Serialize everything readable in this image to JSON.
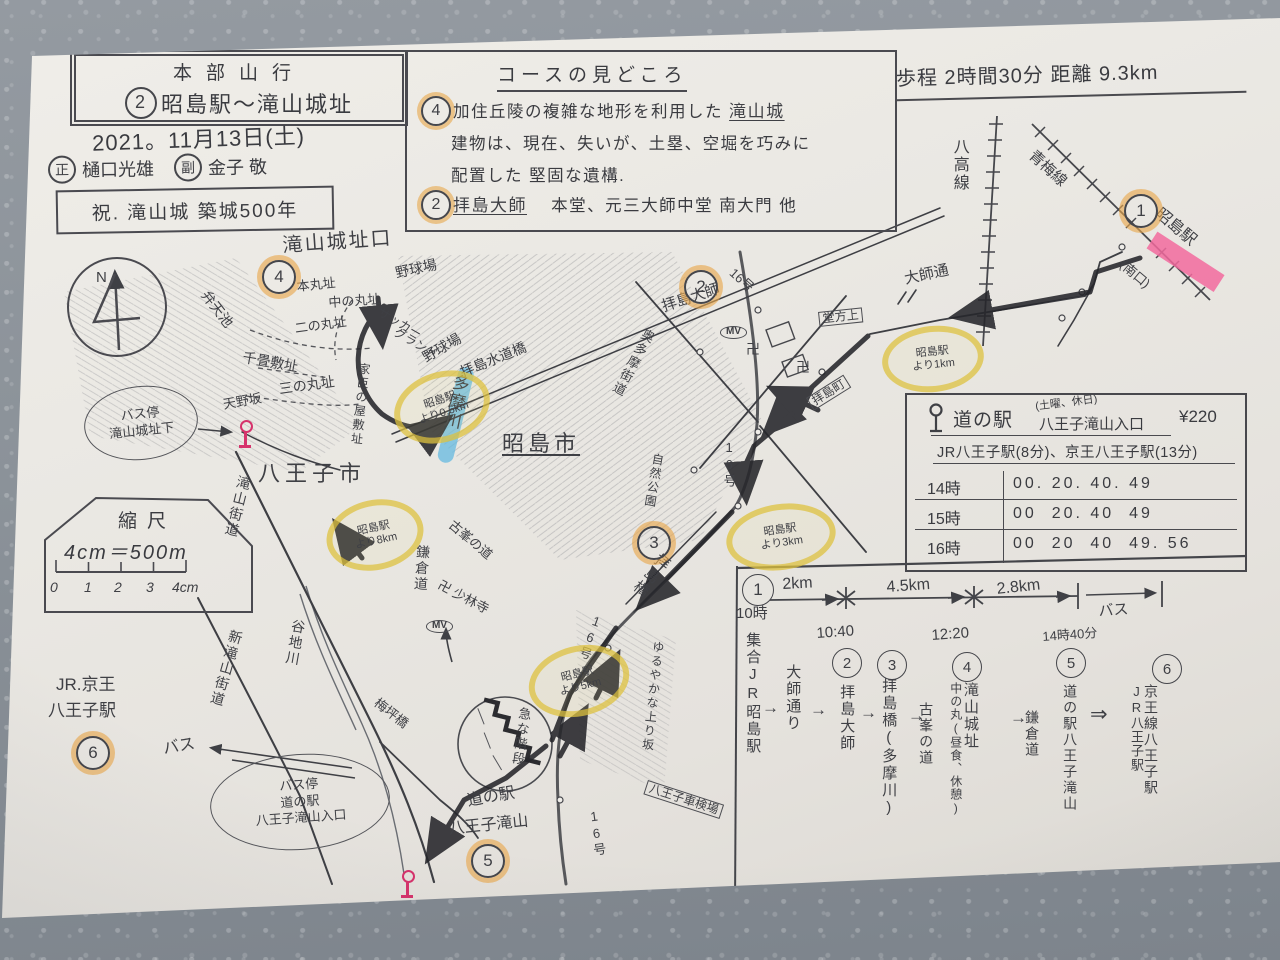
{
  "header": {
    "club": "本部山行",
    "course_no": "2",
    "course_title": "昭島駅〜滝山城址",
    "date": "2021。11月13日(土)",
    "leader_role": "正",
    "leader_name": "樋口光雄",
    "subleader_role": "副",
    "subleader_name": "金子 敬",
    "anniversary": "祝. 滝山城 築城500年",
    "stats": "歩程 2時間30分 距離 9.3km"
  },
  "course_box": {
    "title": "コースの見どころ",
    "item1_num": "4",
    "item1_line1": "加住丘陵の複雑な地形を利用した",
    "item1_line1_em": "滝山城",
    "item1_line2": "建物は、現在、失いが、土塁、空堀を巧みに",
    "item1_line3": "配置した 堅固な遺構.",
    "item2_num": "2",
    "item2_em": "拝島大師",
    "item2_text": "本堂、元三大師中堂 南大門 他"
  },
  "timetable": {
    "stop_name": "道の駅",
    "stop_name2": "八王子滝山入口",
    "note": "(土曜、休日)",
    "fare": "¥220",
    "access": "JR八王子駅(8分)、京王八王子駅(13分)",
    "rows": [
      {
        "hour": "14時",
        "times": "00. 20. 40. 49"
      },
      {
        "hour": "15時",
        "times": "00  20. 40  49"
      },
      {
        "hour": "16時",
        "times": "00  20  40  49. 56"
      }
    ]
  },
  "itinerary": {
    "seg1": "2km",
    "seg2": "4.5km",
    "seg3": "2.8km",
    "seg4": "バス",
    "t1": "10時",
    "t2": "10:40",
    "t4": "12:20",
    "t5": "14時40分",
    "n1": "1",
    "n2": "2",
    "n3": "3",
    "n4": "4",
    "n5": "5",
    "n6": "6",
    "s1": "集合JR昭島駅",
    "via1": "大師通り",
    "s2": "拝島大師",
    "s3": "拝島橋(多摩川)",
    "via2": "古峯の道",
    "s4": "滝山城址",
    "s4_note": "中の丸(昼食、休憩)",
    "via3": "鎌倉道",
    "s5": "道の駅八王子滝山",
    "s6": "京王線八王子駅",
    "s6_note": "JR八王子駅",
    "arrow": "→",
    "darrow": "⇒"
  },
  "scale": {
    "title": "縮尺",
    "formula": "4cm＝500m"
  },
  "map": {
    "labels": [
      {
        "t": "八高線",
        "x": 950,
        "y": 138,
        "s": 16,
        "v": 1
      },
      {
        "t": "青梅線",
        "x": 1036,
        "y": 148,
        "s": 15,
        "rot": 42
      },
      {
        "t": "昭島駅",
        "x": 1162,
        "y": 206,
        "s": 16,
        "rot": 40
      },
      {
        "t": "(南口)",
        "x": 1126,
        "y": 258,
        "s": 13,
        "rot": 40
      },
      {
        "t": "大師通",
        "x": 903,
        "y": 272,
        "s": 15,
        "rot": -12
      },
      {
        "t": "滝山城址口",
        "x": 282,
        "y": 236,
        "s": 20,
        "rot": -4,
        "sp": 2
      },
      {
        "t": "本丸址",
        "x": 296,
        "y": 280,
        "s": 13,
        "rot": -6
      },
      {
        "t": "中の丸址",
        "x": 328,
        "y": 296,
        "s": 13,
        "rot": -4
      },
      {
        "t": "二の丸址",
        "x": 294,
        "y": 322,
        "s": 13,
        "rot": -8
      },
      {
        "t": "弁天池",
        "x": 210,
        "y": 288,
        "s": 14,
        "rot": 52
      },
      {
        "t": "千畳敷址",
        "x": 244,
        "y": 350,
        "s": 14,
        "rot": 10
      },
      {
        "t": "三の丸址",
        "x": 278,
        "y": 382,
        "s": 14,
        "rot": -8
      },
      {
        "t": "天野坂",
        "x": 222,
        "y": 398,
        "s": 13,
        "rot": -10
      },
      {
        "t": "家臣の屋敷址",
        "x": 358,
        "y": 362,
        "s": 12,
        "v": 1,
        "rot": 6
      },
      {
        "t": "野球場",
        "x": 394,
        "y": 266,
        "s": 14,
        "rot": -12
      },
      {
        "t": "サッカー",
        "x": 382,
        "y": 306,
        "s": 12,
        "rot": 30
      },
      {
        "t": "グランド",
        "x": 398,
        "y": 326,
        "s": 12,
        "rot": 30
      },
      {
        "t": "野球場",
        "x": 420,
        "y": 352,
        "s": 14,
        "rot": -30
      },
      {
        "t": "拝島水道橋",
        "x": 458,
        "y": 366,
        "s": 14,
        "rot": -22
      },
      {
        "t": "多摩川",
        "x": 452,
        "y": 372,
        "s": 17,
        "v": 1,
        "rot": 12
      },
      {
        "t": "昭島市",
        "x": 502,
        "y": 432,
        "s": 22,
        "sp": 4,
        "cls": "u"
      },
      {
        "t": "八王子市",
        "x": 258,
        "y": 462,
        "s": 22,
        "sp": 5
      },
      {
        "t": "自然公園",
        "x": 652,
        "y": 452,
        "s": 12,
        "v": 1,
        "rot": 10
      },
      {
        "t": "滝山街道",
        "x": 238,
        "y": 474,
        "s": 14,
        "v": 1,
        "rot": 14
      },
      {
        "t": "新滝山街道",
        "x": 230,
        "y": 628,
        "s": 14,
        "v": 1,
        "rot": 16
      },
      {
        "t": "谷地川",
        "x": 292,
        "y": 618,
        "s": 14,
        "v": 1,
        "rot": 10
      },
      {
        "t": "鎌倉道",
        "x": 416,
        "y": 544,
        "s": 14,
        "v": 1,
        "rot": 4
      },
      {
        "t": "卍 少林寺",
        "x": 442,
        "y": 578,
        "s": 13,
        "rot": 28
      },
      {
        "t": "古峯の道",
        "x": 455,
        "y": 518,
        "s": 13,
        "rot": 40
      },
      {
        "t": "梅坪橋",
        "x": 380,
        "y": 696,
        "s": 13,
        "rot": 38
      },
      {
        "t": "急な階段",
        "x": 518,
        "y": 706,
        "s": 13,
        "v": 1,
        "rot": 8
      },
      {
        "t": "道の駅",
        "x": 466,
        "y": 794,
        "s": 16,
        "rot": -10
      },
      {
        "t": "八王子滝山",
        "x": 448,
        "y": 822,
        "s": 16,
        "rot": -6
      },
      {
        "t": "ゆるやかな上り坂",
        "x": 652,
        "y": 640,
        "s": 12,
        "v": 1,
        "rot": 6
      },
      {
        "t": "八王子車検場",
        "x": 648,
        "y": 780,
        "s": 12,
        "rot": 18,
        "cls": "boxed"
      },
      {
        "t": "16号",
        "x": 736,
        "y": 266,
        "s": 13,
        "rot": 42
      },
      {
        "t": "16号",
        "x": 722,
        "y": 440,
        "s": 13,
        "v": 1
      },
      {
        "t": "16号",
        "x": 592,
        "y": 612,
        "s": 13,
        "v": 1,
        "rot": 20
      },
      {
        "t": "16号",
        "x": 586,
        "y": 810,
        "s": 13,
        "v": 1,
        "rot": -8
      },
      {
        "t": "拝島橋",
        "x": 660,
        "y": 550,
        "s": 15,
        "v": 1,
        "rot": 38
      },
      {
        "t": "拝島大師",
        "x": 660,
        "y": 300,
        "s": 15,
        "rot": -18
      },
      {
        "t": "奥多摩街道",
        "x": 644,
        "y": 326,
        "s": 13,
        "v": 1,
        "rot": 28
      },
      {
        "t": "堂方上",
        "x": 818,
        "y": 312,
        "s": 12,
        "rot": -6,
        "cls": "boxed"
      },
      {
        "t": "拝島町",
        "x": 806,
        "y": 398,
        "s": 12,
        "rot": -32,
        "cls": "boxed"
      },
      {
        "t": "卍",
        "x": 746,
        "y": 342,
        "s": 14
      },
      {
        "t": "卍",
        "x": 796,
        "y": 360,
        "s": 14
      },
      {
        "t": "MV",
        "x": 720,
        "y": 326,
        "s": 10,
        "cls": "penoval"
      },
      {
        "t": "MV",
        "x": 426,
        "y": 620,
        "s": 10,
        "cls": "penoval"
      },
      {
        "t": "JR.京王",
        "x": 56,
        "y": 676,
        "s": 17
      },
      {
        "t": "八王子駅",
        "x": 48,
        "y": 702,
        "s": 17
      },
      {
        "t": "バス",
        "x": 162,
        "y": 742,
        "s": 16,
        "rot": -10
      },
      {
        "t": "N",
        "x": 96,
        "y": 270,
        "s": 15
      },
      {
        "t": "0",
        "x": 50,
        "y": 580,
        "s": 14,
        "cls": "hand-it"
      },
      {
        "t": "1",
        "x": 84,
        "y": 580,
        "s": 14,
        "cls": "hand-it"
      },
      {
        "t": "2",
        "x": 114,
        "y": 580,
        "s": 14,
        "cls": "hand-it"
      },
      {
        "t": "3",
        "x": 146,
        "y": 580,
        "s": 14,
        "cls": "hand-it"
      },
      {
        "t": "4cm",
        "x": 172,
        "y": 580,
        "s": 14,
        "cls": "hand-it"
      }
    ],
    "yellow_notes": [
      {
        "l1": "昭島駅",
        "l2": "より0.6km",
        "x": 393,
        "y": 372,
        "w": 86,
        "h": 58,
        "rot": -18
      },
      {
        "l1": "昭島駅",
        "l2": "より8km",
        "x": 326,
        "y": 500,
        "w": 86,
        "h": 58,
        "rot": -12
      },
      {
        "l1": "昭島駅",
        "l2": "より3km",
        "x": 726,
        "y": 504,
        "w": 98,
        "h": 54,
        "rot": -8
      },
      {
        "l1": "昭島駅",
        "l2": "より5km",
        "x": 528,
        "y": 646,
        "w": 90,
        "h": 58,
        "rot": -14
      },
      {
        "l1": "昭島駅",
        "l2": "より1km",
        "x": 882,
        "y": 326,
        "w": 90,
        "h": 54,
        "rot": -6
      }
    ],
    "orange_numbers": [
      {
        "n": "1",
        "x": 1124,
        "y": 194
      },
      {
        "n": "2",
        "x": 684,
        "y": 270
      },
      {
        "n": "3",
        "x": 637,
        "y": 526
      },
      {
        "n": "4",
        "x": 262,
        "y": 260
      },
      {
        "n": "5",
        "x": 471,
        "y": 844
      },
      {
        "n": "6",
        "x": 76,
        "y": 736
      }
    ],
    "pen_ovals": [
      {
        "lines": [
          "バス停",
          "滝山城址下"
        ],
        "x": 84,
        "y": 386,
        "w": 112,
        "h": 72,
        "rot": -6
      },
      {
        "lines": [
          "バス停",
          "道の駅",
          "八王子滝山入口"
        ],
        "x": 210,
        "y": 754,
        "w": 178,
        "h": 94,
        "rot": -4
      }
    ],
    "bus_stops": [
      {
        "x": 238,
        "y": 420
      },
      {
        "x": 400,
        "y": 870
      }
    ]
  },
  "colors": {
    "yellow": "#dec13d",
    "orange": "#e09a4a",
    "pink": "#ef6ea6",
    "blue": "#5fb8e0",
    "ink": "#3f4045"
  }
}
